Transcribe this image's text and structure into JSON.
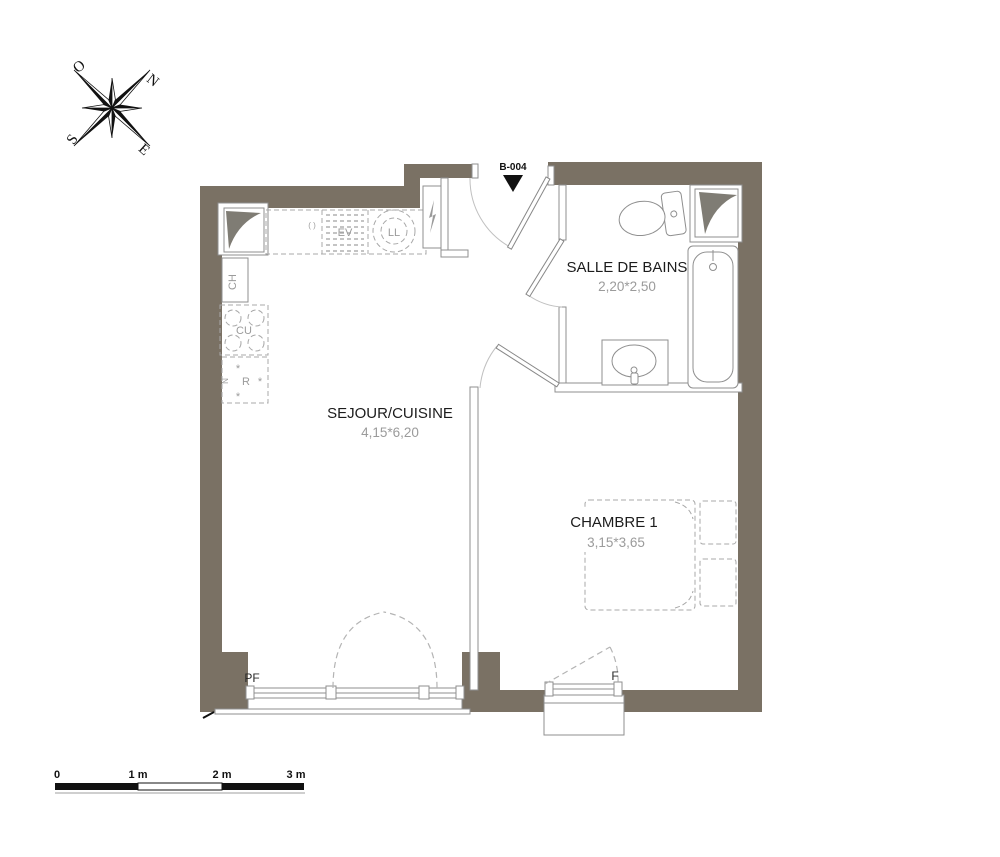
{
  "compass": {
    "north": "N",
    "south": "S",
    "east": "E",
    "west": "O"
  },
  "entrance_door": {
    "label": "B-004"
  },
  "rooms": {
    "living": {
      "name": "SEJOUR/CUISINE",
      "dimensions": "4,15*6,20"
    },
    "bathroom": {
      "name": "SALLE DE BAINS",
      "dimensions": "2,20*2,50"
    },
    "bedroom": {
      "name": "CHAMBRE 1",
      "dimensions": "3,15*3,65"
    }
  },
  "fixtures": {
    "water_heater": "CH",
    "cooktop": "CU",
    "fridge": "R",
    "fridge_note": "N",
    "fridge_mark": "*",
    "sink_unit": "EV",
    "washing_machine": "LL",
    "tap_mark": "( )"
  },
  "openings": {
    "french_window": "PF",
    "bedroom_window": "F"
  },
  "scale_bar": {
    "labels": [
      "0",
      "1 m",
      "2 m",
      "3 m"
    ]
  },
  "colors": {
    "wall": "#7a7164",
    "thin_line": "#8f8f8f",
    "dashed_line": "#a8a8a8",
    "room_text": "#1c1c1c",
    "dim_text": "#9b9b9b"
  }
}
